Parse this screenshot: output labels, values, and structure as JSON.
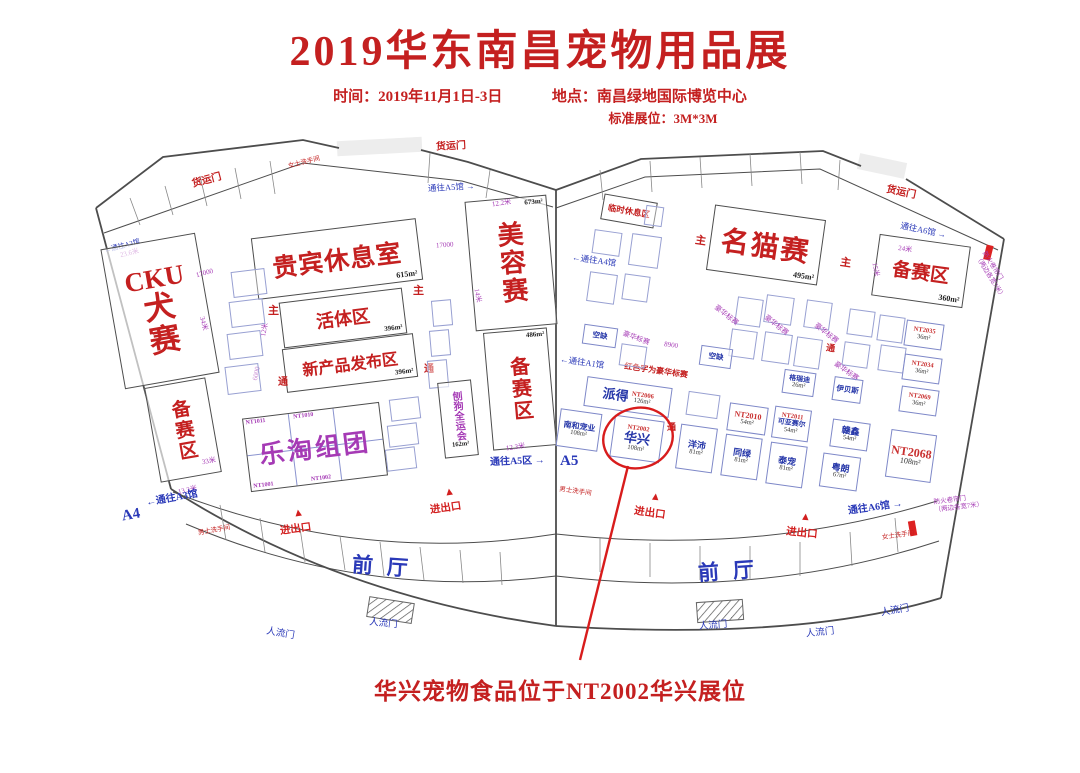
{
  "header": {
    "title": "2019华东南昌宠物用品展",
    "time": "时间：2019年11月1日-3日",
    "place": "地点：南昌绿地国际博览中心",
    "booth_spec": "标准展位：3M*3M"
  },
  "labels": {
    "cargo_door": "货运门",
    "people_door": "人流门",
    "gate": "进出口",
    "front_hall": "前厅",
    "to_a3": "通往A3馆",
    "to_a4": "通往A4馆",
    "to_a5_hall": "通往A5馆",
    "to_a5_zone": "通往A5区",
    "to_a6": "通往A6馆",
    "to_a1": "通往A1馆",
    "a4": "A4",
    "a5": "A5",
    "main_aisle": "主",
    "aisle": "通",
    "mens": "男士洗手间",
    "womens": "女士洗手间",
    "fire_door": "防火卷帘门",
    "fire_door_note": "（两边各宽7米）"
  },
  "left_hall": {
    "cku": {
      "lines": [
        "CKU",
        "犬",
        "赛"
      ]
    },
    "cku_prep": {
      "name": "备赛区"
    },
    "vip": {
      "name": "贵宾休息室",
      "size": "615m²"
    },
    "live": {
      "name": "活体区",
      "size": "396m²"
    },
    "new_product": {
      "name": "新产品发布区",
      "size": "396m²"
    },
    "letao": {
      "name": "乐淘组团",
      "codes": [
        "NT1011",
        "NT1010",
        "NT1001",
        "NT1002"
      ]
    },
    "dog_games": {
      "name": "刨狗全运会",
      "size": "162m²"
    },
    "grooming": {
      "name": "美容赛",
      "size": "673m²"
    },
    "grooming_prep": {
      "name": "备赛区",
      "size": "486m²"
    },
    "dims": {
      "d17000a": "17000",
      "d17000b": "17000",
      "d236": "23.6米",
      "d34": "34米",
      "d33": "33米",
      "d133": "13.3米",
      "d123": "12.3米",
      "d122": "12.2米",
      "d14": "14米",
      "d6000": "6000",
      "d12": "12米"
    }
  },
  "right_hall": {
    "cat_show": {
      "name": "名猫赛",
      "size": "495m²"
    },
    "prep": {
      "name": "备赛区",
      "size": "360m²"
    },
    "rest_area": {
      "name": "临时休息区"
    },
    "legend": "红色字为豪华标赛",
    "deluxe": "豪华标赛",
    "dims": {
      "d24": "24米",
      "d15": "15米",
      "d8900": "8900"
    },
    "booths": [
      {
        "code": "NT2006",
        "name": "派得",
        "size": "126m²"
      },
      {
        "name": "南和宠业",
        "size": "108m²"
      },
      {
        "code": "NT2002",
        "name": "华兴",
        "size": "108m²"
      },
      {
        "name": "洋沛",
        "size": "81m²"
      },
      {
        "name": "同绿",
        "size": "81m²"
      },
      {
        "name": "泰宠",
        "size": "81m²"
      },
      {
        "code": "NT2010",
        "size": "54m²"
      },
      {
        "code": "NT2011",
        "name": "可亚赛尔",
        "size": "54m²"
      },
      {
        "name": "格瑞迪",
        "size": "26m²"
      },
      {
        "name": "伊贝斯"
      },
      {
        "name": "赣鑫",
        "size": "54m²"
      },
      {
        "name": "粤朗",
        "size": "67m²"
      },
      {
        "code": "NT2035",
        "size": "36m²"
      },
      {
        "code": "NT2034",
        "size": "36m²"
      },
      {
        "code": "NT2069",
        "size": "36m²"
      },
      {
        "code": "NT2068",
        "size": "108m²"
      },
      {
        "name": "空缺"
      },
      {
        "name": "空缺"
      }
    ]
  },
  "annotation": "华兴宠物食品位于NT2002华兴展位"
}
